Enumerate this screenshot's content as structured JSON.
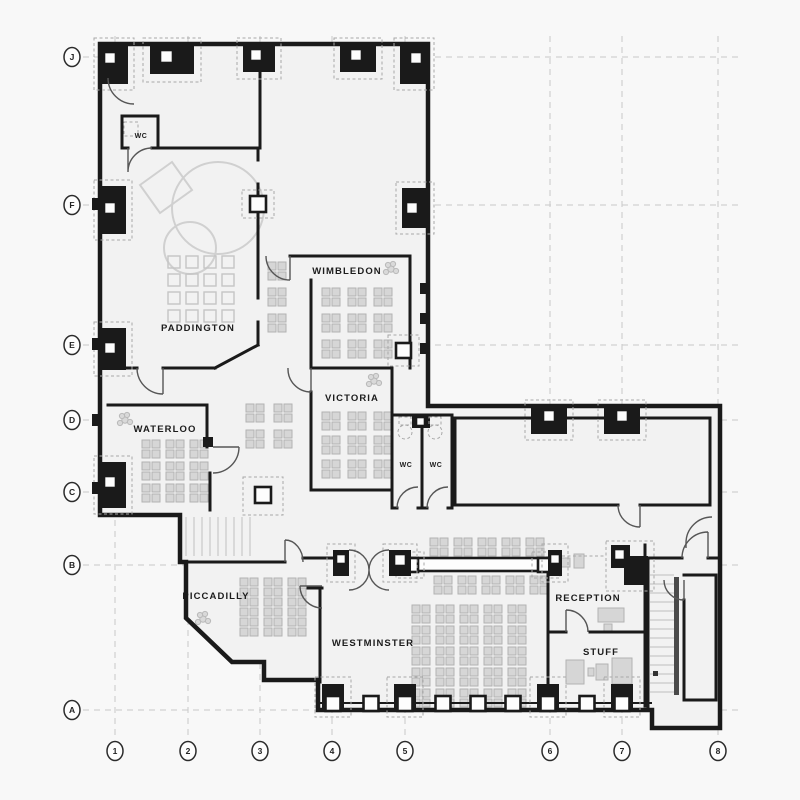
{
  "page": {
    "title": "Office floor plan drawing"
  },
  "grid": {
    "rows": [
      {
        "label": "J"
      },
      {
        "label": "F"
      },
      {
        "label": "E"
      },
      {
        "label": "D"
      },
      {
        "label": "C"
      },
      {
        "label": "B"
      },
      {
        "label": "A"
      }
    ],
    "cols": [
      {
        "label": "1"
      },
      {
        "label": "2"
      },
      {
        "label": "3"
      },
      {
        "label": "4"
      },
      {
        "label": "5"
      },
      {
        "label": "6"
      },
      {
        "label": "7"
      },
      {
        "label": "8"
      }
    ]
  },
  "rooms": {
    "paddington": {
      "label": "PADDINGTON"
    },
    "wimbledon": {
      "label": "WIMBLEDON"
    },
    "victoria": {
      "label": "VICTORIA"
    },
    "waterloo": {
      "label": "WATERLOO"
    },
    "piccadilly": {
      "label": "PICCADILLY"
    },
    "westminster": {
      "label": "WESTMINSTER"
    },
    "reception": {
      "label": "RECEPTION"
    },
    "stuff": {
      "label": "STUFF"
    },
    "wc_northwest": {
      "label": "WC"
    },
    "wc_middle_left": {
      "label": "WC"
    },
    "wc_middle_right": {
      "label": "WC"
    }
  },
  "colors": {
    "wall": "#1a1a1a",
    "interior": "#f2f2f2",
    "background": "#f8f8f8",
    "furniture": "#d6d6d6",
    "grid_line": "#c9c9c9",
    "marker_stroke": "#2b2b2b"
  }
}
